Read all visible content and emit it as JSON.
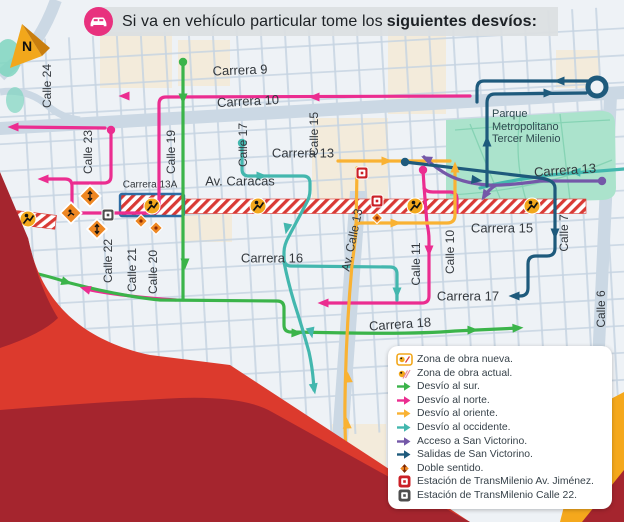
{
  "title": {
    "regular": "Si va en vehículo particular tome los",
    "bold": "siguientes desvíos:"
  },
  "compass": {
    "label": "N"
  },
  "park": {
    "lines": [
      "Parque",
      "Metropolitano",
      "Tercer Milenio"
    ]
  },
  "street_labels": [
    {
      "text": "Carrera 9",
      "x": 240,
      "y": 70,
      "rot": -2,
      "size": 13
    },
    {
      "text": "Carrera 10",
      "x": 248,
      "y": 101,
      "rot": -3,
      "size": 13
    },
    {
      "text": "Carrera 13",
      "x": 303,
      "y": 153,
      "rot": 0,
      "size": 13
    },
    {
      "text": "Av. Caracas",
      "x": 240,
      "y": 181,
      "rot": 0,
      "size": 13
    },
    {
      "text": "Carrera 13A",
      "x": 150,
      "y": 185,
      "rot": 0,
      "size": 10
    },
    {
      "text": "Carrera 13",
      "x": 565,
      "y": 170,
      "rot": -4,
      "size": 13
    },
    {
      "text": "Carrera 15",
      "x": 502,
      "y": 228,
      "rot": 0,
      "size": 13
    },
    {
      "text": "Carrera 16",
      "x": 272,
      "y": 258,
      "rot": 0,
      "size": 13
    },
    {
      "text": "Carrera 17",
      "x": 468,
      "y": 296,
      "rot": 0,
      "size": 13
    },
    {
      "text": "Carrera 18",
      "x": 400,
      "y": 324,
      "rot": -4,
      "size": 13
    },
    {
      "text": "Calle 24",
      "x": 47,
      "y": 86,
      "rot": -90,
      "size": 12
    },
    {
      "text": "Calle 23",
      "x": 88,
      "y": 152,
      "rot": -90,
      "size": 12
    },
    {
      "text": "Calle 22",
      "x": 108,
      "y": 261,
      "rot": -90,
      "size": 12
    },
    {
      "text": "Calle 21",
      "x": 132,
      "y": 270,
      "rot": -90,
      "size": 12
    },
    {
      "text": "Calle 20",
      "x": 153,
      "y": 272,
      "rot": -90,
      "size": 12
    },
    {
      "text": "Calle 19",
      "x": 171,
      "y": 152,
      "rot": -90,
      "size": 12
    },
    {
      "text": "Calle 17",
      "x": 243,
      "y": 145,
      "rot": -90,
      "size": 12
    },
    {
      "text": "Calle 15",
      "x": 314,
      "y": 134,
      "rot": -90,
      "size": 12
    },
    {
      "text": "Calle 11",
      "x": 416,
      "y": 264,
      "rot": -90,
      "size": 12
    },
    {
      "text": "Calle 10",
      "x": 450,
      "y": 252,
      "rot": -90,
      "size": 12
    },
    {
      "text": "Calle 7",
      "x": 564,
      "y": 233,
      "rot": -90,
      "size": 12
    },
    {
      "text": "Calle 6",
      "x": 601,
      "y": 309,
      "rot": -90,
      "size": 12
    },
    {
      "text": "Av. Calle 13",
      "x": 352,
      "y": 240,
      "rot": -78,
      "size": 12
    }
  ],
  "legend": {
    "items": [
      {
        "icon": "zona-nueva",
        "label": "Zona de obra nueva."
      },
      {
        "icon": "zona-actual",
        "label": "Zona de obra actual."
      },
      {
        "icon": "arrow-green",
        "label": "Desvío al sur."
      },
      {
        "icon": "arrow-pink",
        "label": "Desvío al norte."
      },
      {
        "icon": "arrow-yellow",
        "label": "Desvío al oriente."
      },
      {
        "icon": "arrow-teal",
        "label": "Desvío al occidente."
      },
      {
        "icon": "arrow-purple",
        "label": "Acceso a San Victorino."
      },
      {
        "icon": "arrow-blue",
        "label": "Salidas de San Victorino."
      },
      {
        "icon": "doble",
        "label": "Doble sentido."
      },
      {
        "icon": "station-red",
        "label": "Estación de TransMilenio Av. Jiménez."
      },
      {
        "icon": "station-gray",
        "label": "Estación de TransMilenio Calle 22."
      }
    ]
  },
  "colors": {
    "pink": "#EB2D90",
    "green": "#3BB44A",
    "yellow": "#F9B233",
    "teal": "#43B7AE",
    "purple": "#7458A8",
    "blue": "#1E5A7C",
    "amber": "#F2A71B",
    "diamond_orange": "#EE8722",
    "hatch_red": "#D93A35",
    "zone_border_blue": "#2E6DA4",
    "station_red": "#CB2027",
    "station_gray": "#4E4E4E",
    "park_green": "#ABE3CC",
    "red_dark": "#A5252E",
    "red_bright": "#DC3A2D",
    "wedge_yellow": "#F5A81C",
    "title_pink": "#E8317E"
  }
}
